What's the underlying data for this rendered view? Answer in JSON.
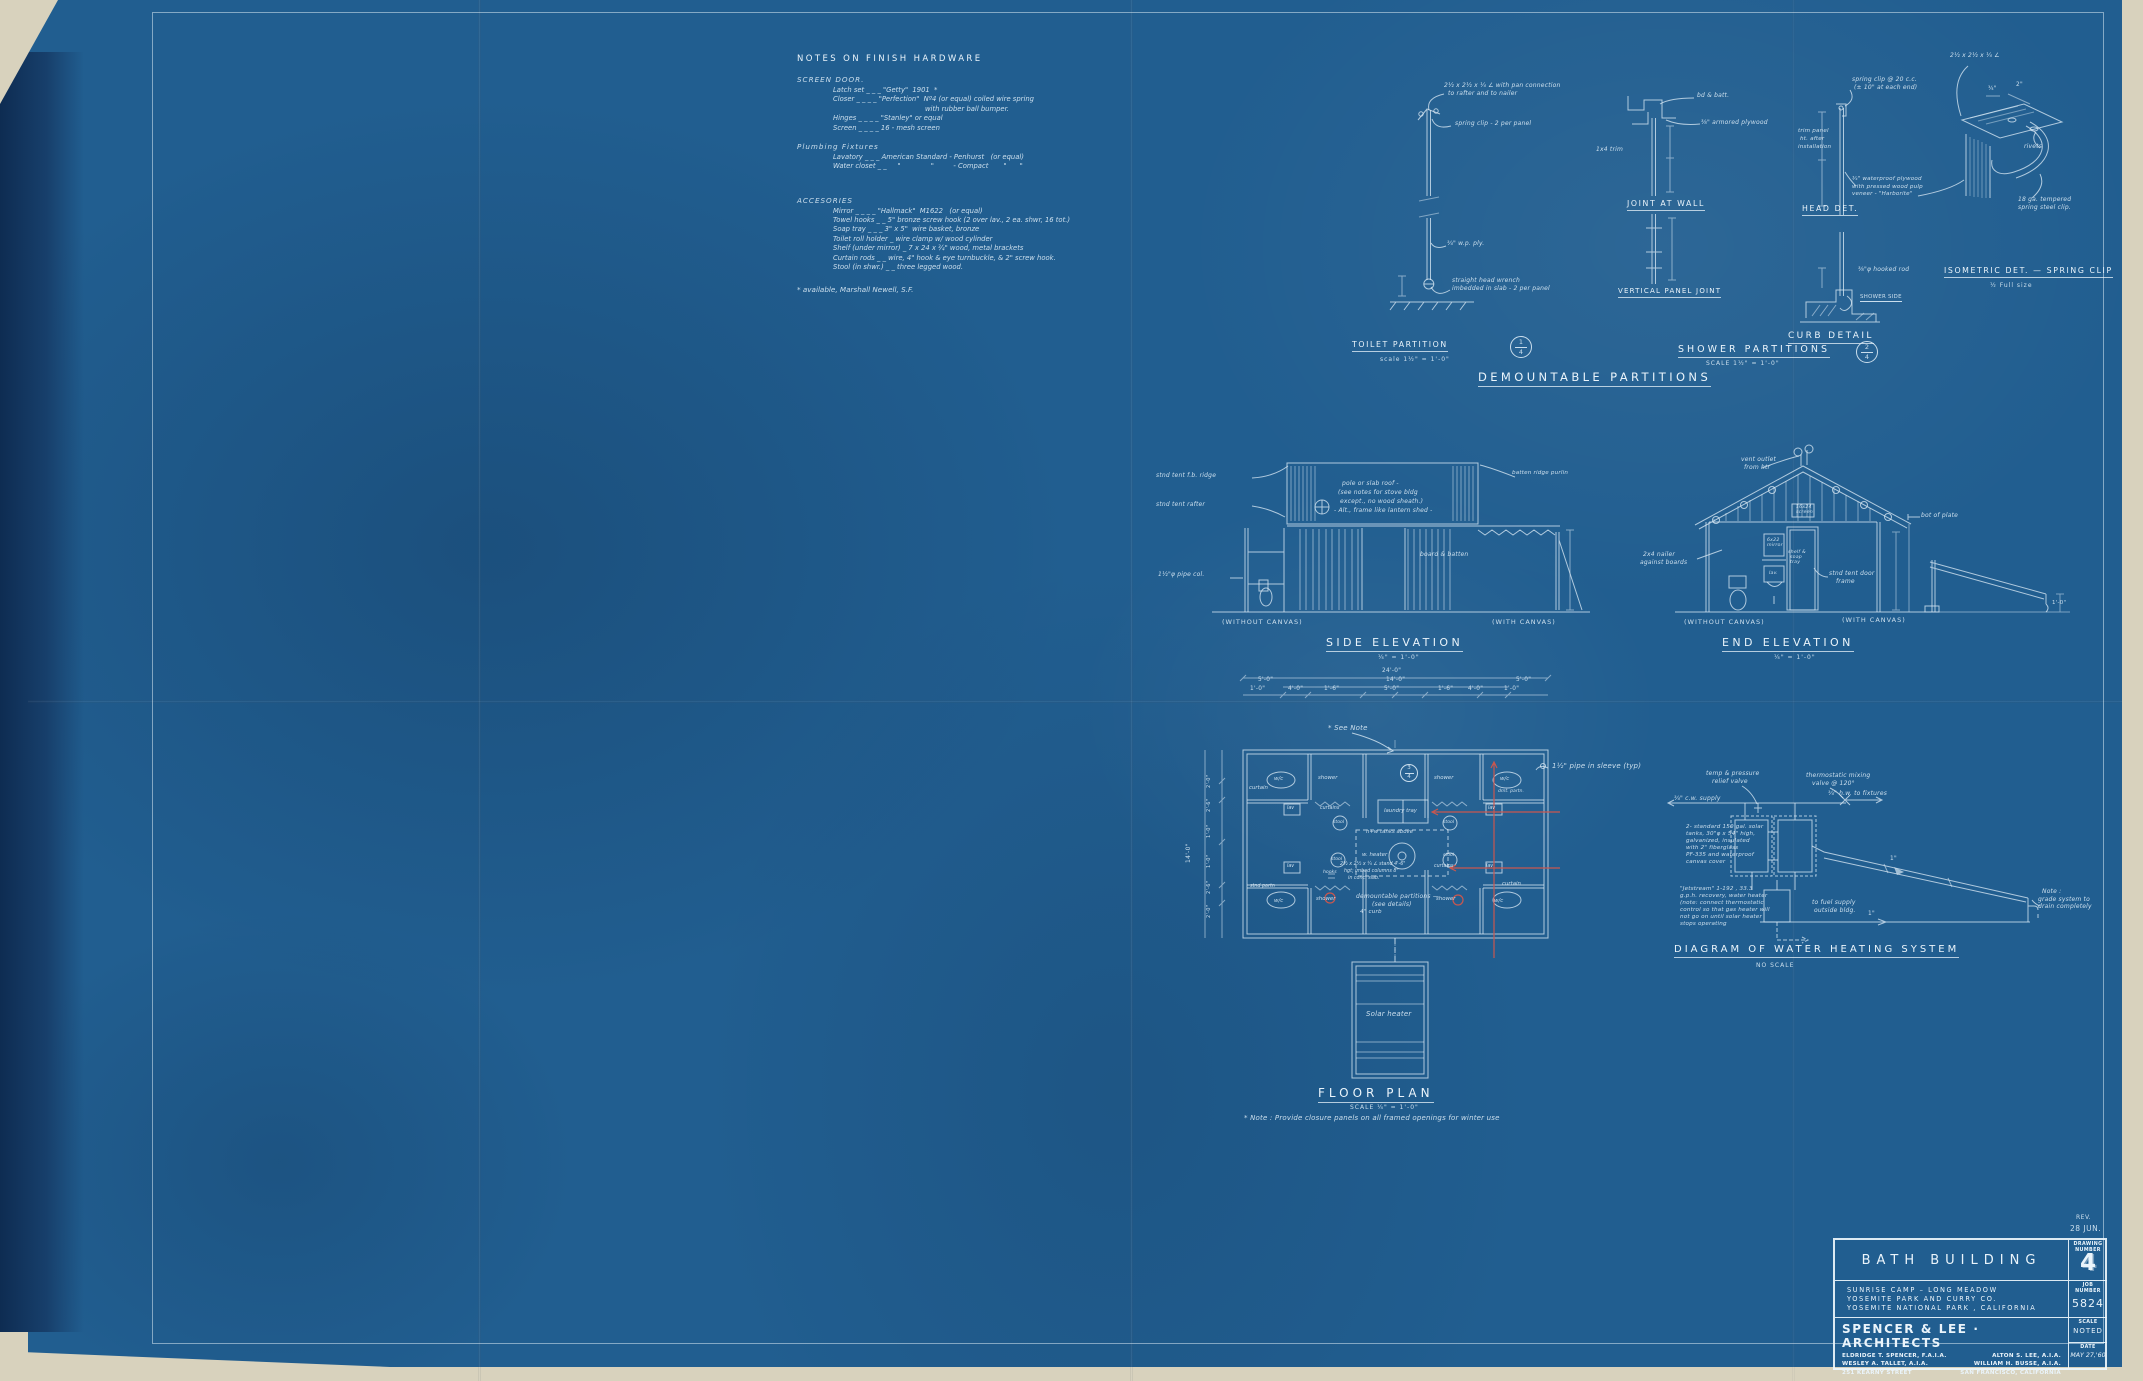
{
  "colors": {
    "paper_edge": "#d8d2bd",
    "blueprint_blue": "#215e90",
    "fold_strip": "#173f6b",
    "line_ink": "#d8e8f4",
    "revision_red": "#c9574f"
  },
  "notes": {
    "title": "NOTES ON FINISH HARDWARE",
    "screen_door": {
      "heading": "SCREEN DOOR.",
      "latch": "Latch set _ _ _ \"Getty\"  1901  *",
      "closer": "Closer _ _ _ _ \"Perfection\"  Nº4 (or equal) coiled wire spring",
      "closer2": "with rubber ball bumper.",
      "hinges": "Hinges _ _ _ _ \"Stanley\" or equal",
      "screen": "Screen _ _ _ _ 16 - mesh screen"
    },
    "plumbing": {
      "heading": "Plumbing Fixtures",
      "lavatory": "Lavatory _ _ _ American Standard - Penhurst   (or equal)",
      "water_closet": "Water closet _ _     \"              \"         - Compact       \"      \""
    },
    "accessories": {
      "heading": "ACCESORIES",
      "mirror": "Mirror _ _ _ _ \"Hallmack\"  M1622   (or equal)",
      "towel_hooks": "Towel hooks _ _ 5\" bronze screw hook (2 over lav., 2 ea. shwr, 16 tot.)",
      "soap_tray": "Soap tray _ _ _ 3\" x 5\"  wire basket, bronze",
      "toilet_roll": "Toilet roll holder _ wire clamp w/ wood cylinder",
      "shelf": "Shelf (under mirror) _ 7 x 24 x ¾\" wood, metal brackets",
      "curtain_rods": "Curtain rods _ _ wire, 4\" hook & eye turnbuckle, & 2\" screw hook.",
      "stool": "Stool (in shwr.) _ _ three legged wood."
    },
    "footnote": "* available, Marshall Newell, S.F."
  },
  "partitions": {
    "section_title": "DEMOUNTABLE PARTITIONS",
    "toilet": {
      "title": "TOILET PARTITION",
      "scale": "scale 1½\" = 1'-0\"",
      "marker_num": "1",
      "marker_den": "4",
      "angle_note1": "2½ x 2½ x ¼ ∠ with pan connection",
      "angle_note2": "to rafter and to nailer",
      "clip_note": "spring clip - 2 per panel",
      "ply_note": "¾\" w.p. ply.",
      "wrench_note1": "straight head wrench",
      "wrench_note2": "imbedded in slab - 2 per panel"
    },
    "joint_at_wall": {
      "title": "JOINT AT WALL",
      "bd_batt": "bd & batt.",
      "armored_ply": "⅜\" armored plywood",
      "trim": "1x4 trim"
    },
    "vertical_panel_joint": {
      "title": "VERTICAL PANEL JOINT"
    },
    "head_detail": {
      "title": "HEAD DET.",
      "spring_clip1": "spring clip @ 20 c.c.",
      "spring_clip2": "(± 10\" at each end)",
      "trim_panel1": "trim panel",
      "trim_panel2": "ht. after",
      "trim_panel3": "installation",
      "plywood_note": "¾\" waterproof plywood with pressed wood pulp veneer - \"Harborite\""
    },
    "curb_detail": {
      "title": "CURB DETAIL",
      "hook_rod": "⅜\"φ hooked rod",
      "shower_side": "SHOWER SIDE"
    },
    "shower": {
      "title": "SHOWER PARTITIONS",
      "scale": "SCALE 1½\" = 1'-0\"",
      "marker_num": "2",
      "marker_den": "4"
    },
    "isometric": {
      "title": "ISOMETRIC DET. — SPRING CLIP",
      "scale": "½  Full size",
      "angle_note": "2½ x 2½ x ¼ ∠",
      "dim_a": "¾\"",
      "dim_b": "2\"",
      "rivets": "rivets",
      "clip_note1": "18 ga. tempered",
      "clip_note2": "spring steel clip."
    }
  },
  "side_elevation": {
    "title": "SIDE ELEVATION",
    "scale": "¼\" = 1'-0\"",
    "ridge": "stnd tent f.b. ridge",
    "rafter": "stnd tent rafter",
    "pipe_col": "1½\"φ pipe col.",
    "roof_note1": "pole or slab roof -",
    "roof_note2": "(see notes for stove bldg",
    "roof_note3": "except., no wood sheath.)",
    "roof_note4": "- Alt., frame like lantern shed -",
    "board_batten": "board & batten",
    "purlin": "batten ridge purlin",
    "without_canvas": "(WITHOUT CANVAS)",
    "with_canvas": "(WITH CANVAS)"
  },
  "end_elevation": {
    "title": "END ELEVATION",
    "scale": "¼\" = 1'-0\"",
    "vent1": "vent outlet",
    "vent2": "from htr",
    "screen1": "16x24",
    "screen2": "screen",
    "nailer1": "2x4 nailer",
    "nailer2": "against boards",
    "mirror1": "6x22",
    "mirror2": "mirror",
    "shelf1": "shelf &",
    "shelf2": "soap",
    "shelf3": "tray",
    "lav": "lav.",
    "door1": "stnd tent door",
    "door2": "frame",
    "plate": "bot of plate",
    "dim": "1'-0\"",
    "without_canvas": "(WITHOUT CANVAS)",
    "with_canvas": "(WITH CANVAS)"
  },
  "floor_plan": {
    "title": "FLOOR PLAN",
    "scale": "SCALE ¼\" = 1'-0\"",
    "note": "* Note : Provide  closure  panels  on  all  framed  openings  for  winter  use",
    "see_note": "* See Note",
    "pipe_sleeve": "1½\" pipe in sleeve (typ)",
    "marker_num": "3",
    "marker_den": "4",
    "dim_total": "24'-0\"",
    "dim_wing": "5'-0\"",
    "dim_center": "14'-0\"",
    "dim_wing_r": "5'-0\"",
    "seg1": "1'-0\"",
    "seg2": "4'-0\"",
    "seg3": "1'-6\"",
    "seg4": "5'-0\"",
    "seg5": "1'-6\"",
    "seg6": "4'-0\"",
    "seg7": "1'-0\"",
    "dim_side": "14'-0\"",
    "ld1": "2'-0\"",
    "ld2": "2'-6\"",
    "ld3": "1'-0\"",
    "ld4": "1'-0\"",
    "ld5": "2'-6\"",
    "ld6": "2'-0\"",
    "wc": "w/c",
    "lav": "lav",
    "shower": "shower",
    "stool": "stool",
    "curtain": "curtain",
    "curtains": "curtains",
    "hooks": "hooks",
    "stnd_partn": "stnd partn",
    "dmt_partn": "dmt. partn.",
    "laundry": "laundry tray",
    "tanks": "h+w tanks above",
    "heater": "w. heater",
    "stand1": "2½ x 2½ x ¼ ∠ stand 4'-6\"",
    "stand2": "hgt; imbed columns 8\"",
    "stand3": "in conc. slab.",
    "demount1": "demountable partitions —",
    "demount2": "(see details)",
    "curb": "4\" curb",
    "solar_heater": "Solar heater"
  },
  "water_heating": {
    "title": "DIAGRAM OF WATER HEATING SYSTEM",
    "scale": "NO SCALE",
    "relief1": "temp & pressure",
    "relief2": "relief valve",
    "mixing1": "thermostatic mixing",
    "mixing2": "valve @ 120°",
    "hw": "¾\" h.w. to fixtures",
    "cw": "¾\" c.w. supply",
    "tank1": "2- standard 150 gal. solar",
    "tank2": "tanks, 30\"φ x 54\" high,",
    "tank3": "galvanized, insulated",
    "tank4": "with 2\" fiberglass",
    "tank5": "PF-335 and waterproof",
    "tank6": "canvas cover",
    "htr1": "\"Jetstream\" 1-192 , 33.3",
    "htr2": "g.p.h. recovery, water heater",
    "htr3": "(note: connect thermostatic",
    "htr4": "control so that gas heater will",
    "htr5": "not go on until solar heater",
    "htr6": "stops operating",
    "fuel1": "to fuel supply",
    "fuel2": "outside bldg.",
    "pipe_a": "1\"",
    "pipe_b": "1\"",
    "grade1": "Note :",
    "grade2": "grade system to",
    "grade3": "drain completely"
  },
  "title_block": {
    "rev_label": "REV.",
    "rev_date": "28 JUN.",
    "title": "BATH BUILDING",
    "project1": "SUNRISE CAMP  –  LONG MEADOW",
    "project2": "YOSEMITE PARK AND CURRY CO.",
    "project3": "YOSEMITE NATIONAL PARK , CALIFORNIA",
    "firm": "SPENCER & LEE  ·  ARCHITECTS",
    "partner1": "ELDRIDGE T. SPENCER, F.A.I.A.",
    "partner2": "ALTON S. LEE, A.I.A.",
    "partner3": "WESLEY A. TALLET, A.I.A.",
    "partner4": "WILLIAM H. BUSSE, A.I.A.",
    "address1": "251 KEARNY STREET",
    "address2": "SAN FRANCISCO, CALIFORNIA",
    "drawing_label1": "DRAWING",
    "drawing_label2": "NUMBER",
    "drawing_number": "4",
    "job_label1": "JOB",
    "job_label2": "NUMBER",
    "job_number": "5824",
    "scale_label": "SCALE",
    "scale_value": "NOTED",
    "date_label": "DATE",
    "date_value": "MAY 27,'60"
  }
}
